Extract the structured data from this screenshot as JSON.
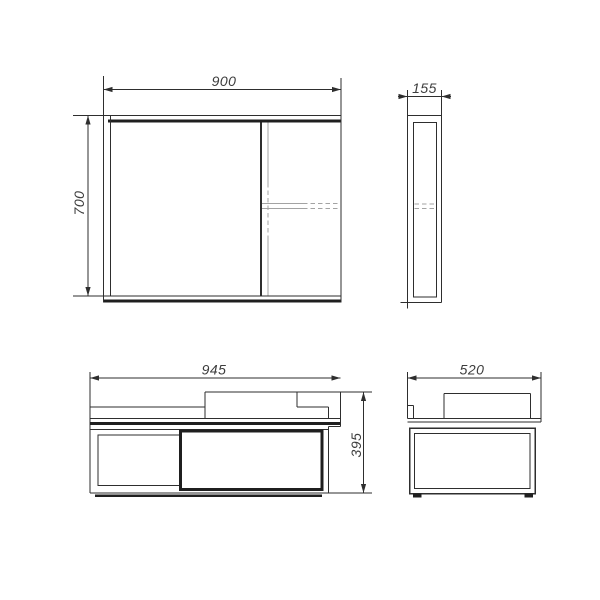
{
  "drawing": {
    "views": {
      "mirror_front": {
        "width_label": "900",
        "height_label": "700"
      },
      "mirror_side": {
        "depth_label": "155"
      },
      "vanity_front": {
        "width_label": "945",
        "height_label": "395"
      },
      "vanity_side": {
        "depth_label": "520"
      }
    },
    "colors": {
      "background": "#ffffff",
      "line": "#2e2e2e",
      "bold_line": "#1f1f1f",
      "secondary_line": "#a3a3a3",
      "label_text": "#3d3d3d"
    }
  }
}
